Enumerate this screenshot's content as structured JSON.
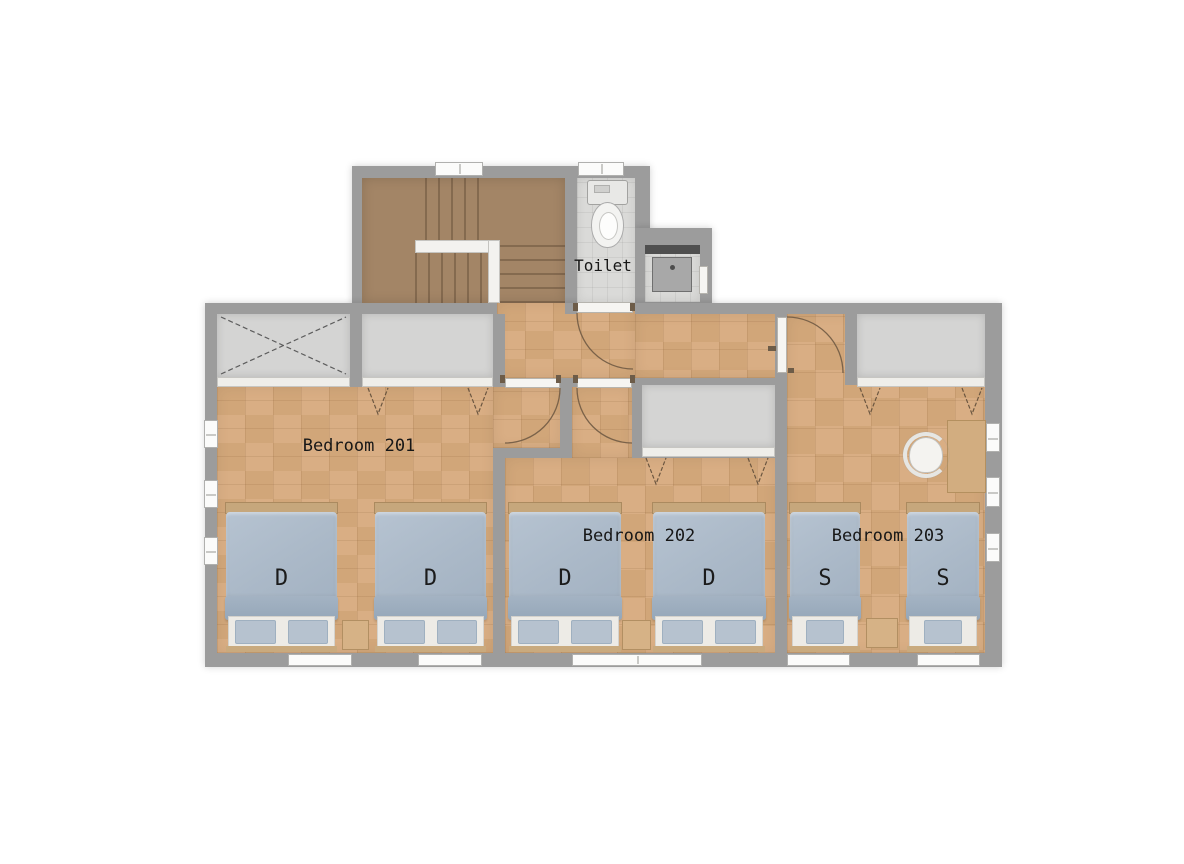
{
  "plan": {
    "floor_labels": {
      "bedroom201": "Bedroom 201",
      "bedroom202": "Bedroom 202",
      "bedroom203": "Bedroom 203",
      "toilet": "Toilet"
    },
    "beds": [
      {
        "room": "Bedroom 201",
        "size_label": "D"
      },
      {
        "room": "Bedroom 201",
        "size_label": "D"
      },
      {
        "room": "Bedroom 202",
        "size_label": "D"
      },
      {
        "room": "Bedroom 202",
        "size_label": "D"
      },
      {
        "room": "Bedroom 203",
        "size_label": "S"
      },
      {
        "room": "Bedroom 203",
        "size_label": "S"
      }
    ],
    "colors": {
      "wall": "#9c9c9c",
      "wood_floor": "#d8ac81",
      "stair_floor": "#a38566",
      "tile_floor": "#dadad8",
      "closet_interior": "#d4d4d3",
      "bed_comforter": "#adbbc9",
      "bed_frame_wood": "#c6a77c",
      "background": "#ffffff"
    }
  }
}
